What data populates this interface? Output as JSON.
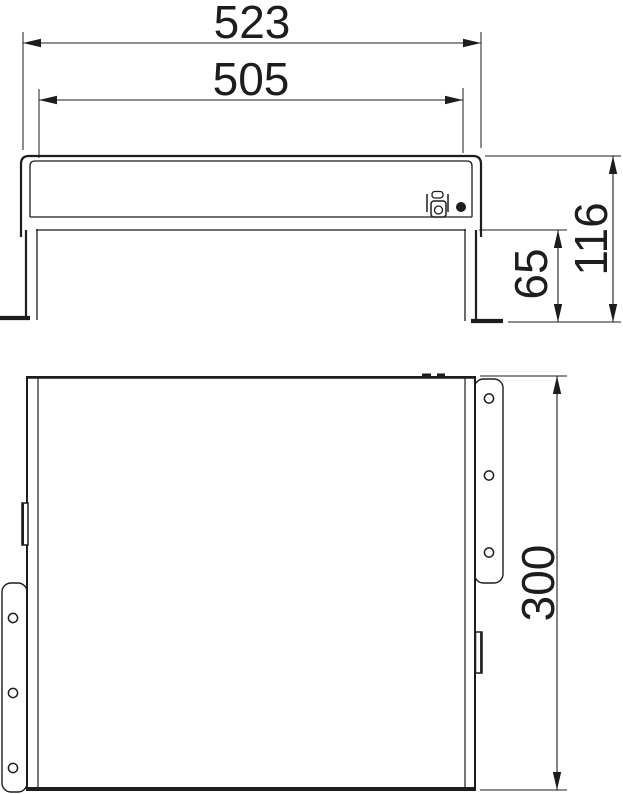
{
  "drawing": {
    "background": "#ffffff",
    "line_color": "#1d1d1b"
  },
  "dimensions": {
    "overall_width": "523",
    "inner_width": "505",
    "total_height": "116",
    "leg_height": "65",
    "side_height": "300"
  }
}
